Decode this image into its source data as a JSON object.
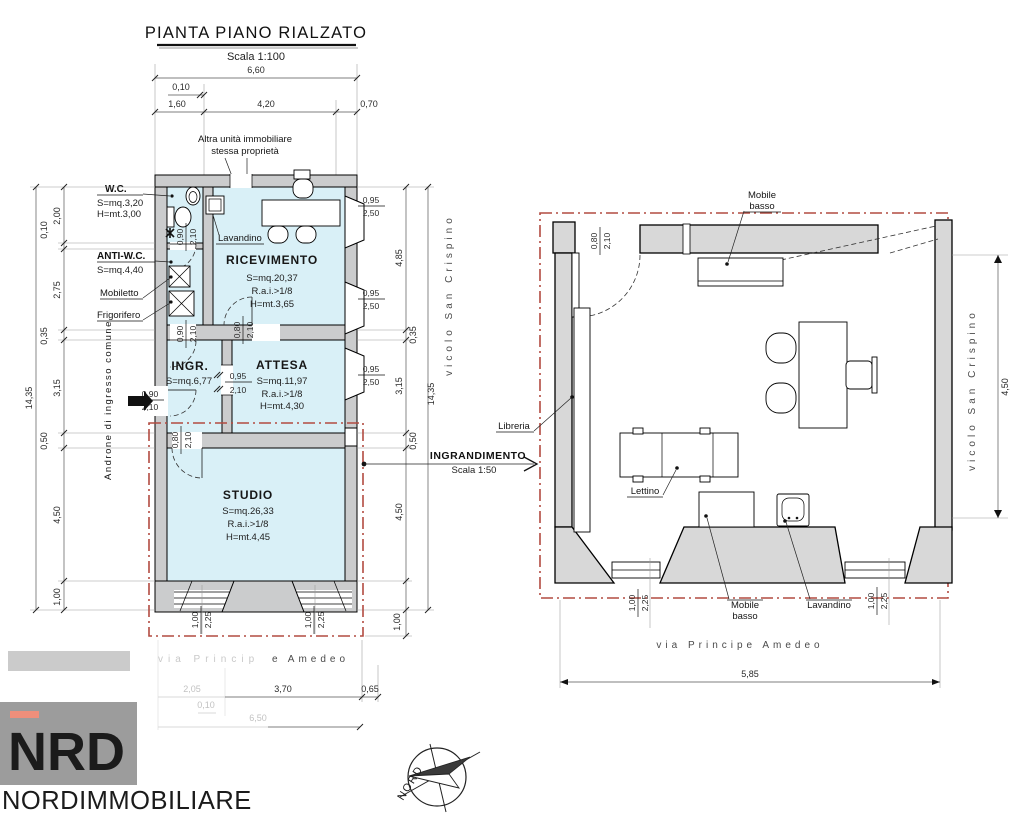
{
  "title": {
    "main": "PIANTA PIANO RIALZATO",
    "scale": "Scala 1:100"
  },
  "callout": {
    "title": "INGRANDIMENTO",
    "scale": "Scala 1:50"
  },
  "rooms": {
    "wc": {
      "name": "W.C.",
      "area": "S=mq.3,20",
      "height": "H=mt.3,00"
    },
    "antiwc": {
      "name": "ANTI-W.C.",
      "area": "S=mq.4,40"
    },
    "ricevimento": {
      "name": "RICEVIMENTO",
      "area": "S=mq.20,37",
      "rai": "R.a.i.>1/8",
      "height": "H=mt.3,65"
    },
    "ingresso": {
      "name": "INGR.",
      "area": "S=mq.6,77"
    },
    "attesa": {
      "name": "ATTESA",
      "area": "S=mq.11,97",
      "rai": "R.a.i.>1/8",
      "height": "H=mt.4,30"
    },
    "studio": {
      "name": "STUDIO",
      "area": "S=mq.26,33",
      "rai": "R.a.i.>1/8",
      "height": "H=mt.4,45"
    }
  },
  "labels": {
    "altra1": "Altra unità immobiliare",
    "altra2": "stessa proprietà",
    "lavandino": "Lavandino",
    "mobiletto": "Mobiletto",
    "frigorifero": "Frigorifero",
    "androne": "Androne di ingresso comune",
    "libreria": "Libreria",
    "lettino": "Lettino",
    "mobile1": "Mobile",
    "mobile2": "basso"
  },
  "streets": {
    "via": "via Principe Amedeo",
    "via_faded": "via Princip",
    "via_dark": "e Amedeo",
    "vicolo": "vicolo San Crispino"
  },
  "dims": {
    "d010": "0,10",
    "d035": "0,35",
    "d050": "0,50",
    "d065": "0,65",
    "d070": "0,70",
    "d080": "0,80",
    "d090": "0,90",
    "d095": "0,95",
    "d100": "1,00",
    "d160": "1,60",
    "d200": "2,00",
    "d205": "2,05",
    "d210": "2,10",
    "d225": "2,25",
    "d250": "2,50",
    "d275": "2,75",
    "d315": "3,15",
    "d370": "3,70",
    "d420": "4,20",
    "d450": "4,50",
    "d485": "4,85",
    "d585": "5,85",
    "d650": "6,50",
    "d660": "6,60",
    "d1435": "14,35"
  },
  "compass": {
    "label": "NORD"
  },
  "logo": {
    "n": "N",
    "rd": "RD",
    "name": "NORDIMMOBILIARE"
  },
  "colors": {
    "room_fill": "#d9f0f7",
    "wall_fill": "#cbcccd",
    "wall_fill_enlarged": "#d8d8d8",
    "boundary_red": "#b24b41",
    "logo_bg": "#9c9c9c",
    "logo_accent": "#ee8f7b",
    "logo_text": "#8e9093"
  }
}
